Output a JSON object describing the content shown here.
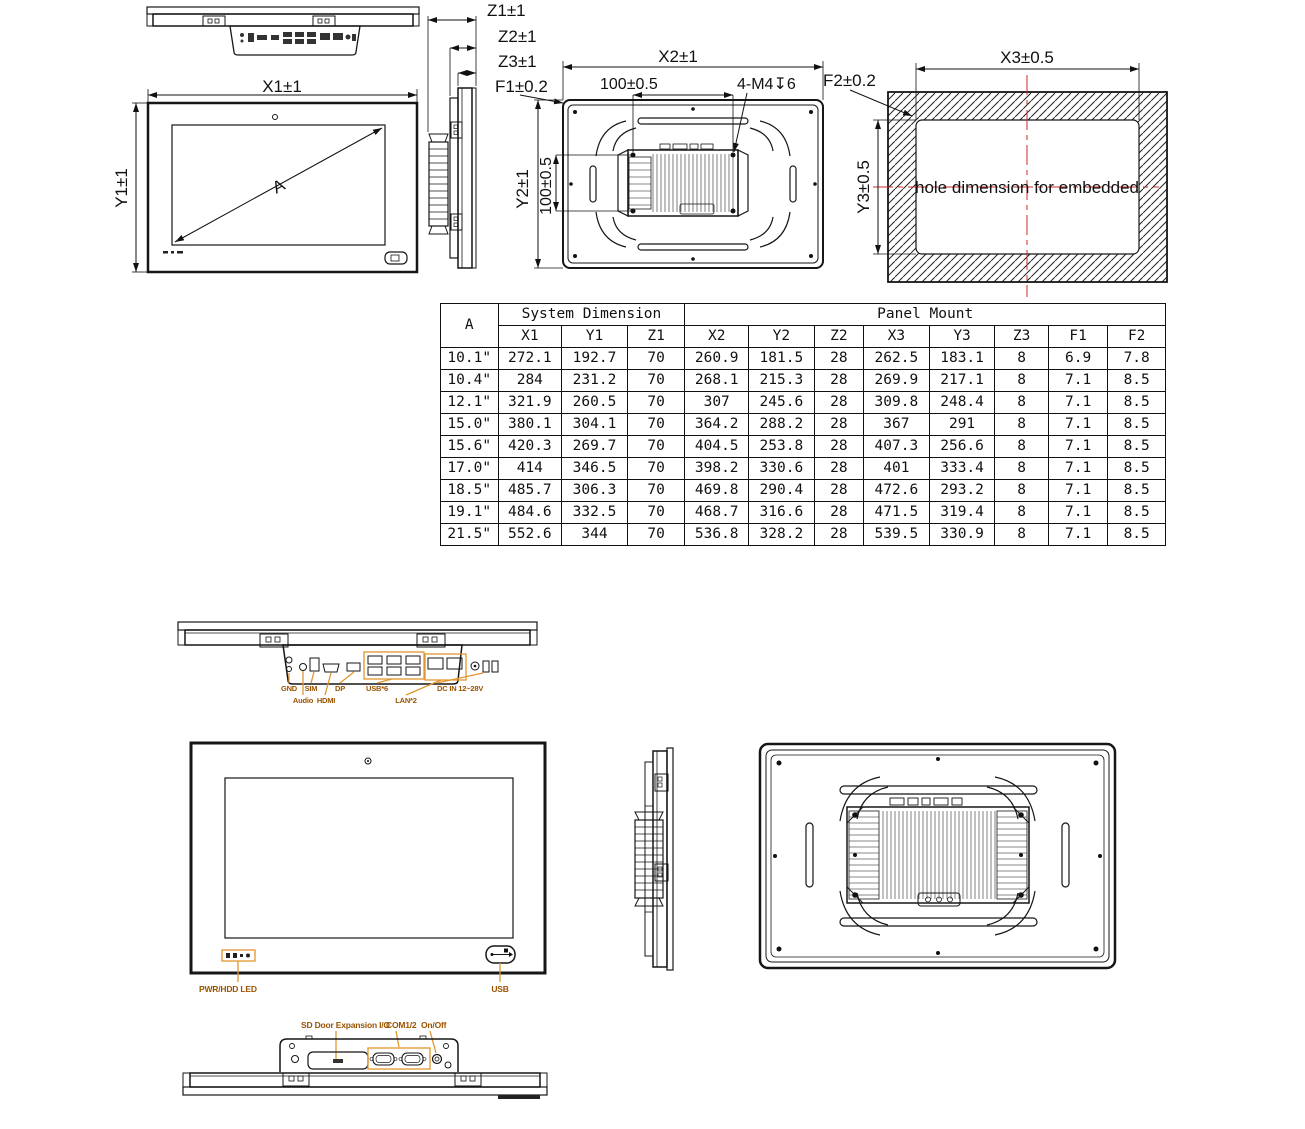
{
  "doc": {
    "kind": "panel-pc-dimension-drawing"
  },
  "colors": {
    "line": "#111111",
    "orange_line": "#e0962e",
    "orange_text": "#9b5300",
    "red_centerline": "#cc2a2a"
  },
  "dims": {
    "x1": "X1±1",
    "y1": "Y1±1",
    "z1": "Z1±1",
    "z2": "Z2±1",
    "z3": "Z3±1",
    "f1": "F1±0.2",
    "x2": "X2±1",
    "pitch_h": "100±0.5",
    "thread": "4-M4↧6",
    "f2": "F2±0.2",
    "y2": "Y2±1",
    "pitch_v": "100±0.5",
    "x3": "X3±0.5",
    "y3": "Y3±0.5",
    "diag": "A",
    "hole_note": "hole dimension for embedded"
  },
  "table": {
    "corner": "A",
    "group_system": "System Dimension",
    "group_panel": "Panel Mount",
    "columns": [
      "X1",
      "Y1",
      "Z1",
      "X2",
      "Y2",
      "Z2",
      "X3",
      "Y3",
      "Z3",
      "F1",
      "F2"
    ],
    "rows": [
      [
        "10.1\"",
        "272.1",
        "192.7",
        "70",
        "260.9",
        "181.5",
        "28",
        "262.5",
        "183.1",
        "8",
        "6.9",
        "7.8"
      ],
      [
        "10.4\"",
        "284",
        "231.2",
        "70",
        "268.1",
        "215.3",
        "28",
        "269.9",
        "217.1",
        "8",
        "7.1",
        "8.5"
      ],
      [
        "12.1\"",
        "321.9",
        "260.5",
        "70",
        "307",
        "245.6",
        "28",
        "309.8",
        "248.4",
        "8",
        "7.1",
        "8.5"
      ],
      [
        "15.0\"",
        "380.1",
        "304.1",
        "70",
        "364.2",
        "288.2",
        "28",
        "367",
        "291",
        "8",
        "7.1",
        "8.5"
      ],
      [
        "15.6\"",
        "420.3",
        "269.7",
        "70",
        "404.5",
        "253.8",
        "28",
        "407.3",
        "256.6",
        "8",
        "7.1",
        "8.5"
      ],
      [
        "17.0\"",
        "414",
        "346.5",
        "70",
        "398.2",
        "330.6",
        "28",
        "401",
        "333.4",
        "8",
        "7.1",
        "8.5"
      ],
      [
        "18.5\"",
        "485.7",
        "306.3",
        "70",
        "469.8",
        "290.4",
        "28",
        "472.6",
        "293.2",
        "8",
        "7.1",
        "8.5"
      ],
      [
        "19.1\"",
        "484.6",
        "332.5",
        "70",
        "468.7",
        "316.6",
        "28",
        "471.5",
        "319.4",
        "8",
        "7.1",
        "8.5"
      ],
      [
        "21.5\"",
        "552.6",
        "344",
        "70",
        "536.8",
        "328.2",
        "28",
        "539.5",
        "330.9",
        "8",
        "7.1",
        "8.5"
      ]
    ]
  },
  "io_bottom": {
    "gnd": "GND",
    "sim": "SIM",
    "dp": "DP",
    "usb": "USB*6",
    "dcin": "DC IN 12~28V",
    "audio": "Audio",
    "hdmi": "HDMI",
    "lan": "LAN*2"
  },
  "front": {
    "led": "PWR/HDD LED",
    "usb": "USB"
  },
  "io_top": {
    "door": "SD Door Expansion I/O",
    "com": "COM1/2",
    "power": "On/Off"
  }
}
